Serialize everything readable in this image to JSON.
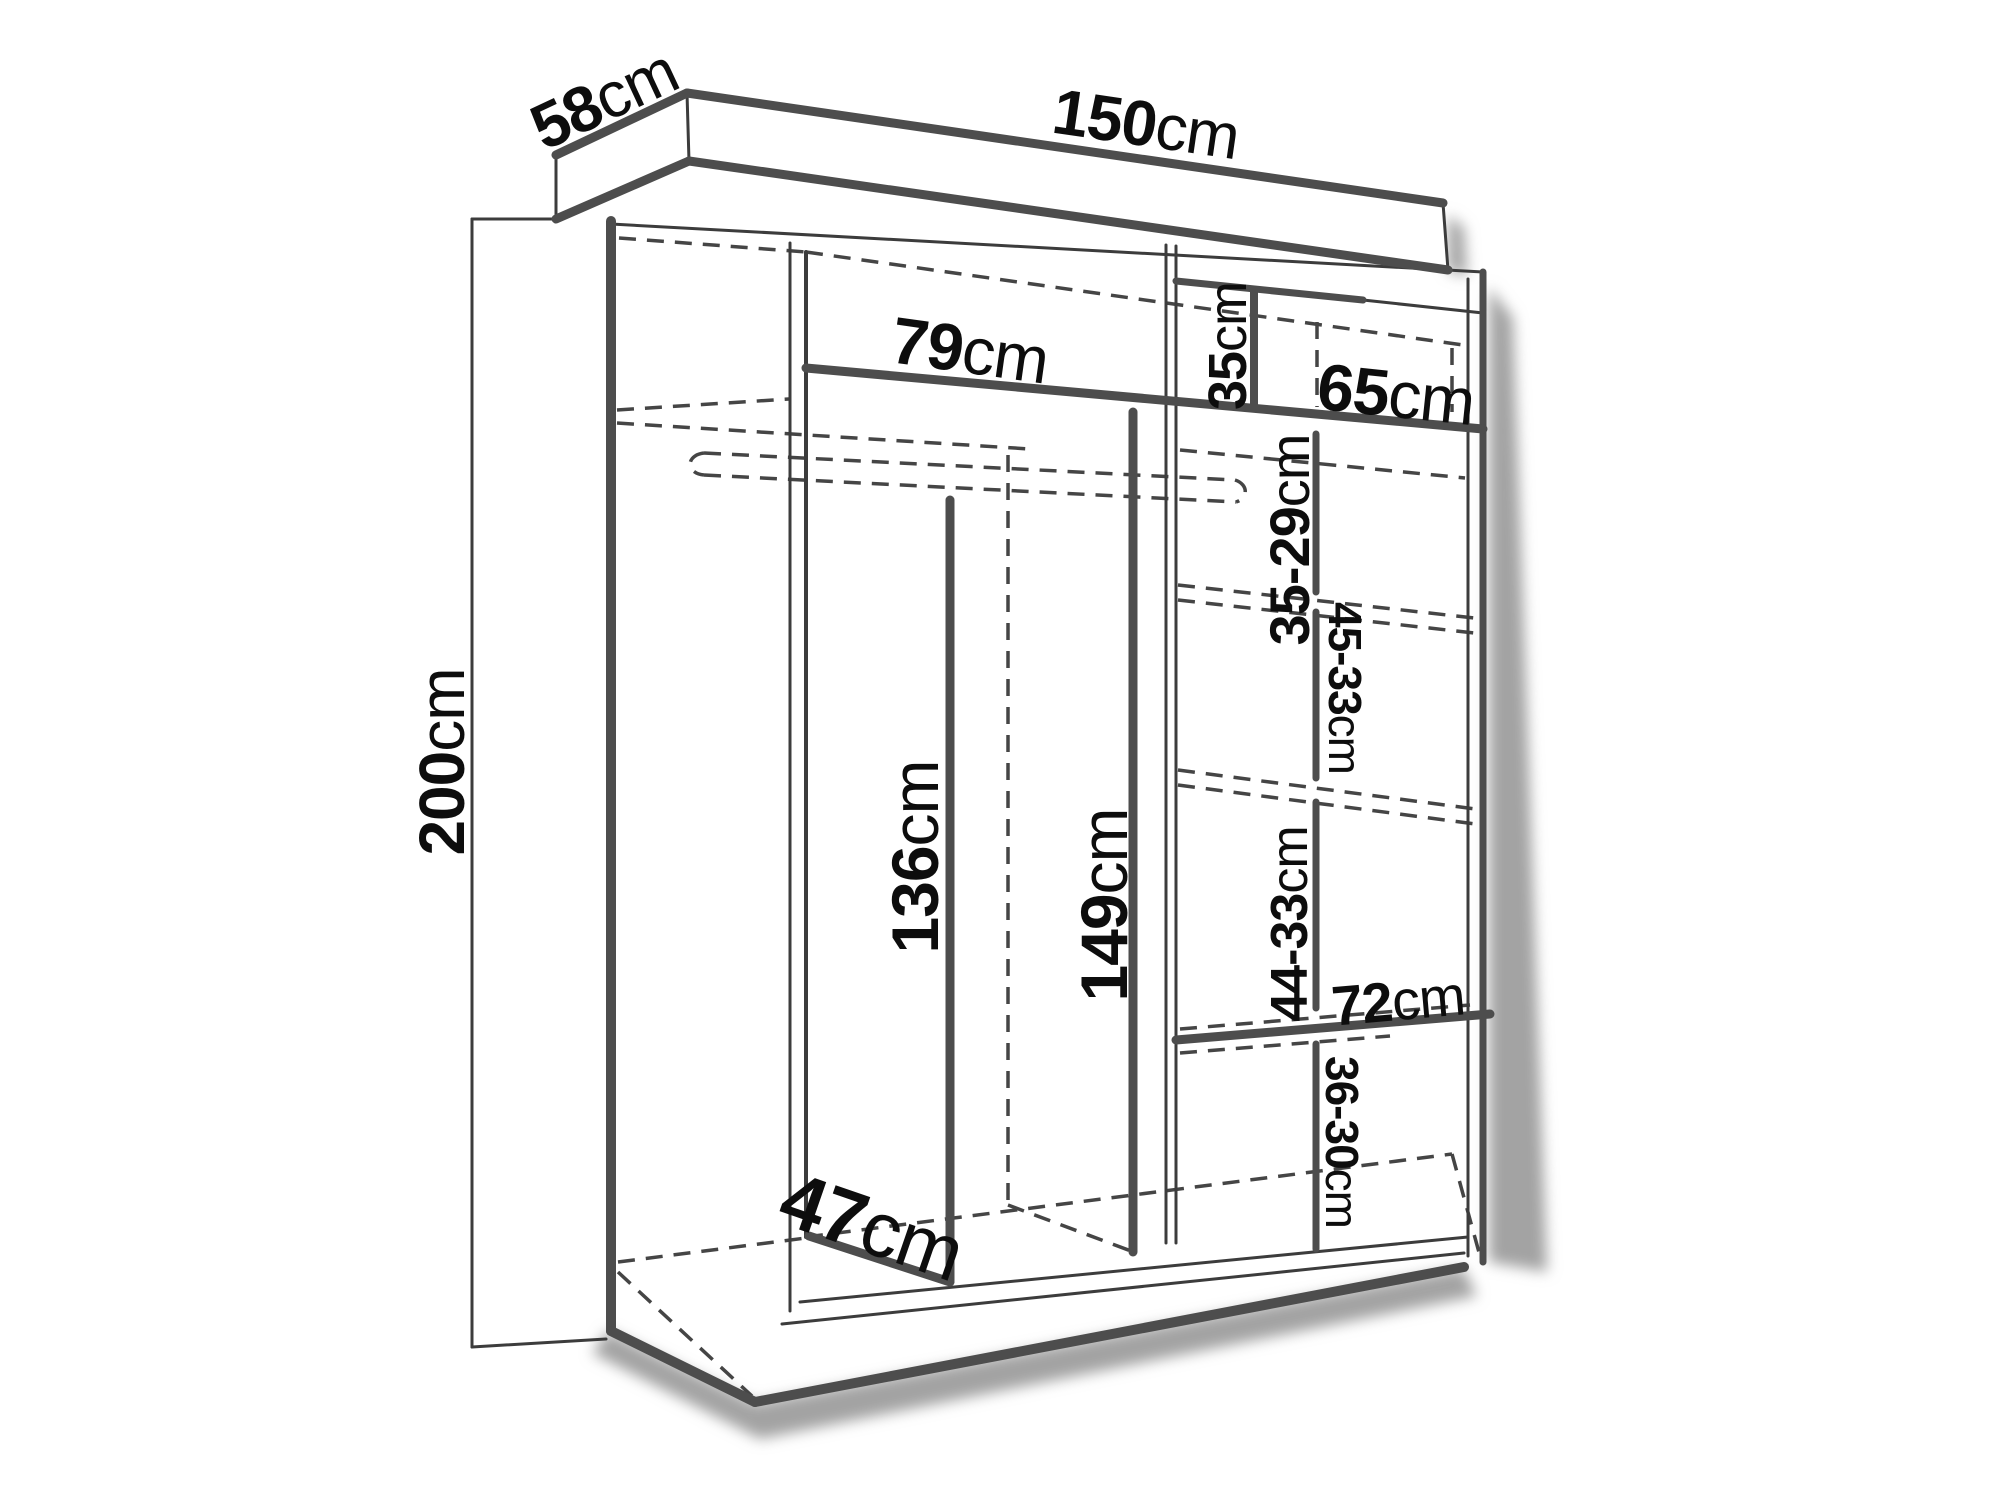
{
  "diagram": {
    "type": "furniture-dimension-diagram",
    "subject": "wardrobe",
    "unit": "cm",
    "overall": {
      "width_cm": 150,
      "depth_cm": 58,
      "height_cm": 200
    },
    "labels": {
      "depth": {
        "value": "58",
        "unit": "cm"
      },
      "width": {
        "value": "150",
        "unit": "cm"
      },
      "height": {
        "value": "200",
        "unit": "cm"
      },
      "left_shelf_width": {
        "value": "79",
        "unit": "cm"
      },
      "top_right_gap": {
        "value": "35",
        "unit": "cm"
      },
      "right_shelf_width": {
        "value": "65",
        "unit": "cm"
      },
      "shelf_gap_1": {
        "value": "35-29",
        "unit": "cm"
      },
      "shelf_gap_2": {
        "value": "45-33",
        "unit": "cm"
      },
      "left_divider_height": {
        "value": "136",
        "unit": "cm"
      },
      "center_divider_height": {
        "value": "149",
        "unit": "cm"
      },
      "shelf_gap_3": {
        "value": "44-33",
        "unit": "cm"
      },
      "lower_shelf_width": {
        "value": "72",
        "unit": "cm"
      },
      "shelf_gap_4": {
        "value": "36-30",
        "unit": "cm"
      },
      "divider_depth": {
        "value": "47",
        "unit": "cm"
      }
    },
    "colors": {
      "background": "#ffffff",
      "thick_line": "#4d4d4d",
      "thin_line": "#3c3c3c",
      "dashed_line": "#454545",
      "text": "#0d0d0d",
      "shadow": "#a3a3a3"
    }
  }
}
